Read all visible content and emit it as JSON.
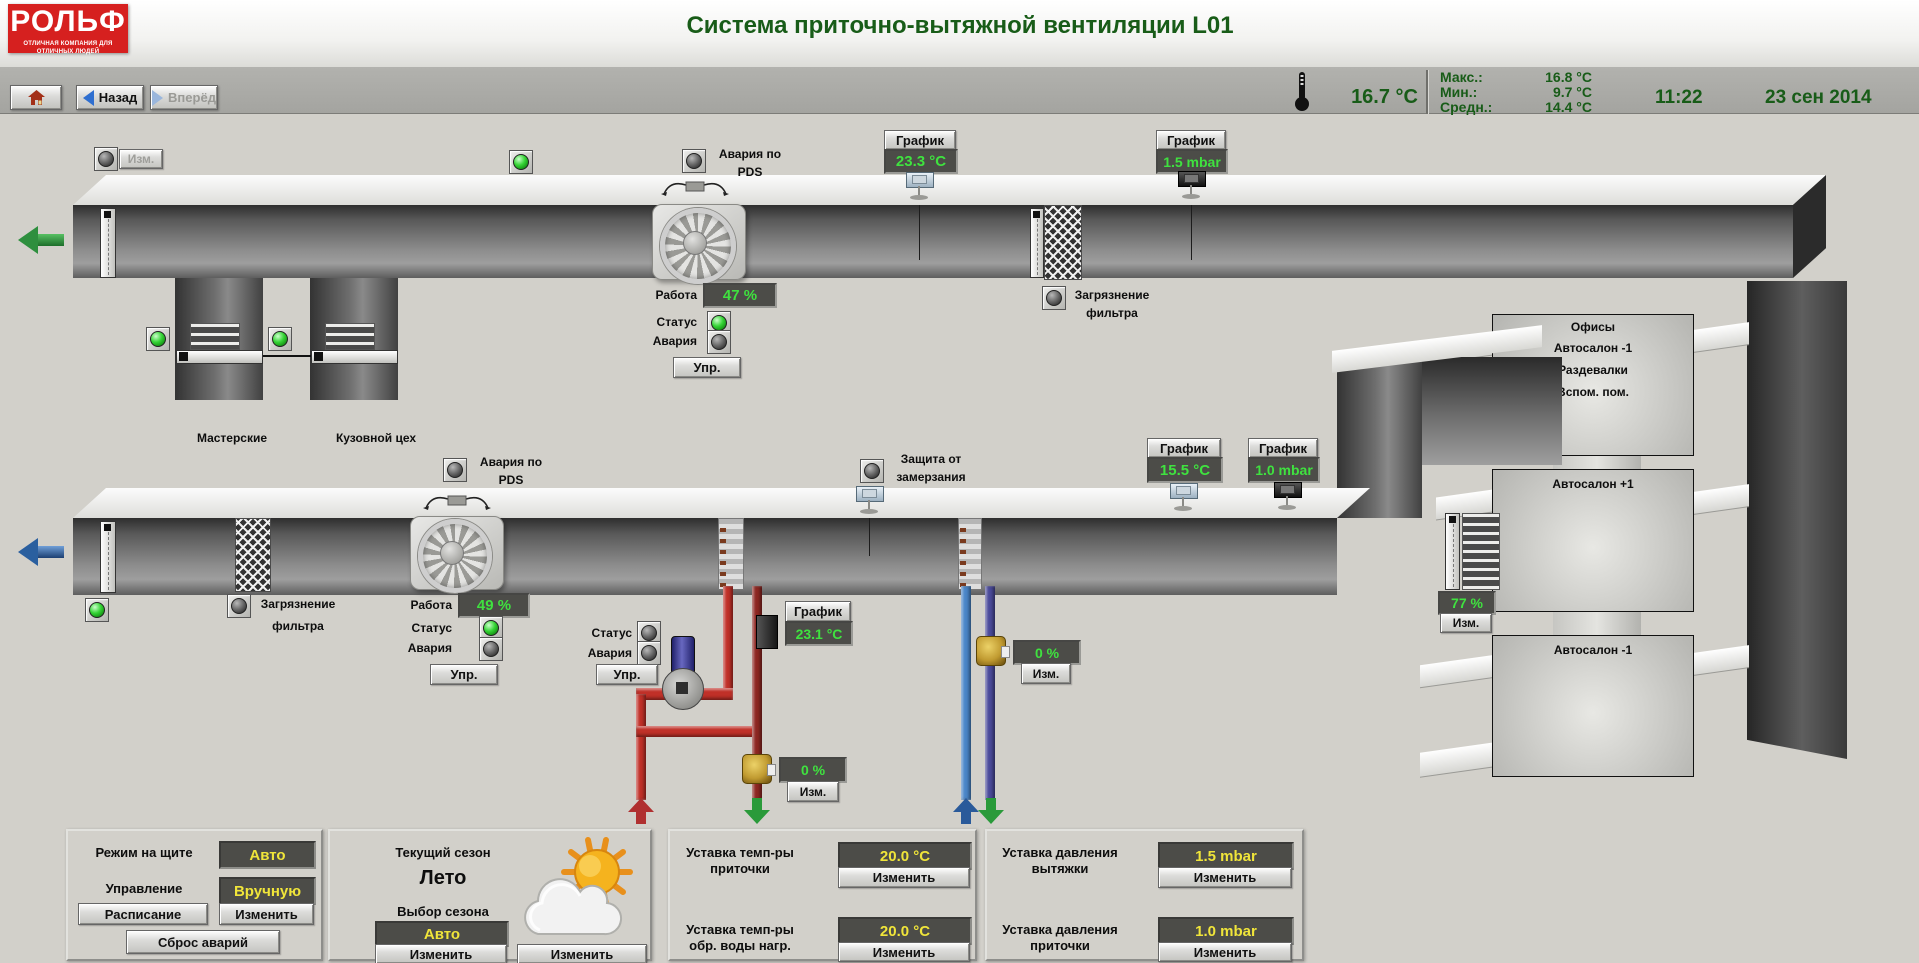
{
  "header": {
    "logo": "РОЛЬФ",
    "slogan": "ОТЛИЧНАЯ КОМПАНИЯ ДЛЯ ОТЛИЧНЫХ ЛЮДЕЙ",
    "title": "Система приточно-вытяжной вентиляции L01"
  },
  "toolbar": {
    "back": "Назад",
    "forward": "Вперёд",
    "outdoor_temp": "16.7 °C",
    "max_label": "Макс.:",
    "max_value": "16.8 °C",
    "min_label": "Мин.:",
    "min_value": "9.7 °C",
    "avg_label": "Средн.:",
    "avg_value": "14.4 °C",
    "time": "11:22",
    "date": "23 сен 2014"
  },
  "labels": {
    "chart": "График",
    "izm": "Изм.",
    "upr": "Упр.",
    "rabota": "Работа",
    "status": "Статус",
    "alarm": "Авария",
    "izmenit": "Изменить",
    "pds_line1": "Авария по",
    "pds_line2": "PDS",
    "filter_line1": "Загрязнение",
    "filter_line2": "фильтра",
    "frost_line1": "Защита от",
    "frost_line2": "замерзания"
  },
  "exhaust": {
    "duct_temp": "23.3 °C",
    "duct_pressure": "1.5 mbar",
    "fan_speed": "47 %",
    "branch1": "Мастерские",
    "branch2": "Кузовной цех"
  },
  "supply": {
    "duct_temp": "15.5 °C",
    "duct_pressure": "1.0 mbar",
    "fan_speed": "49 %",
    "heater_temp": "23.1 °C",
    "heater_valve": "0 %",
    "cooler_valve": "0 %",
    "rooms_damper": "77 %"
  },
  "building": {
    "box1_rooms": [
      "Офисы",
      "Автосалон -1",
      "Раздевалки",
      "Вспом. пом."
    ],
    "box2": "Автосалон +1",
    "box3": "Автосалон -1"
  },
  "panels": {
    "mode": {
      "title": "Режим на щите",
      "mode_value": "Авто",
      "control_label": "Управление",
      "control_value": "Вручную",
      "schedule_btn": "Расписание",
      "change_btn": "Изменить",
      "reset_btn": "Сброс аварий"
    },
    "season": {
      "title": "Текущий сезон",
      "current": "Лето",
      "select_label": "Выбор сезона",
      "select_value": "Авто",
      "change_select_btn": "Изменить",
      "change_season_btn": "Изменить"
    },
    "temp_setpoints": {
      "sp1_line1": "Уставка темп-ры",
      "sp1_line2": "приточки",
      "sp1_value": "20.0 °C",
      "sp1_change_btn": "Изменить",
      "sp2_line1": "Уставка темп-ры",
      "sp2_line2": "обр. воды нагр.",
      "sp2_value": "20.0 °C",
      "sp2_change_btn": "Изменить"
    },
    "pressure_setpoints": {
      "sp1_line1": "Уставка давления",
      "sp1_line2": "вытяжки",
      "sp1_value": "1.5 mbar",
      "sp1_change_btn": "Изменить",
      "sp2_line1": "Уставка давления",
      "sp2_line2": "приточки",
      "sp2_value": "1.0 mbar",
      "sp2_change_btn": "Изменить"
    }
  },
  "colors": {
    "brand_red": "#d6201f",
    "title_green": "#185c18",
    "value_green": "#3fe23f",
    "setpoint_yellow": "#f0e53a",
    "led_green": "#35d435",
    "pipe_hot": "#c03028",
    "pipe_hot_dark": "#8d2722",
    "pipe_cold": "#4a86c8",
    "pipe_cold_return": "#4a4a9a",
    "valve_brass": "#c09a30"
  }
}
